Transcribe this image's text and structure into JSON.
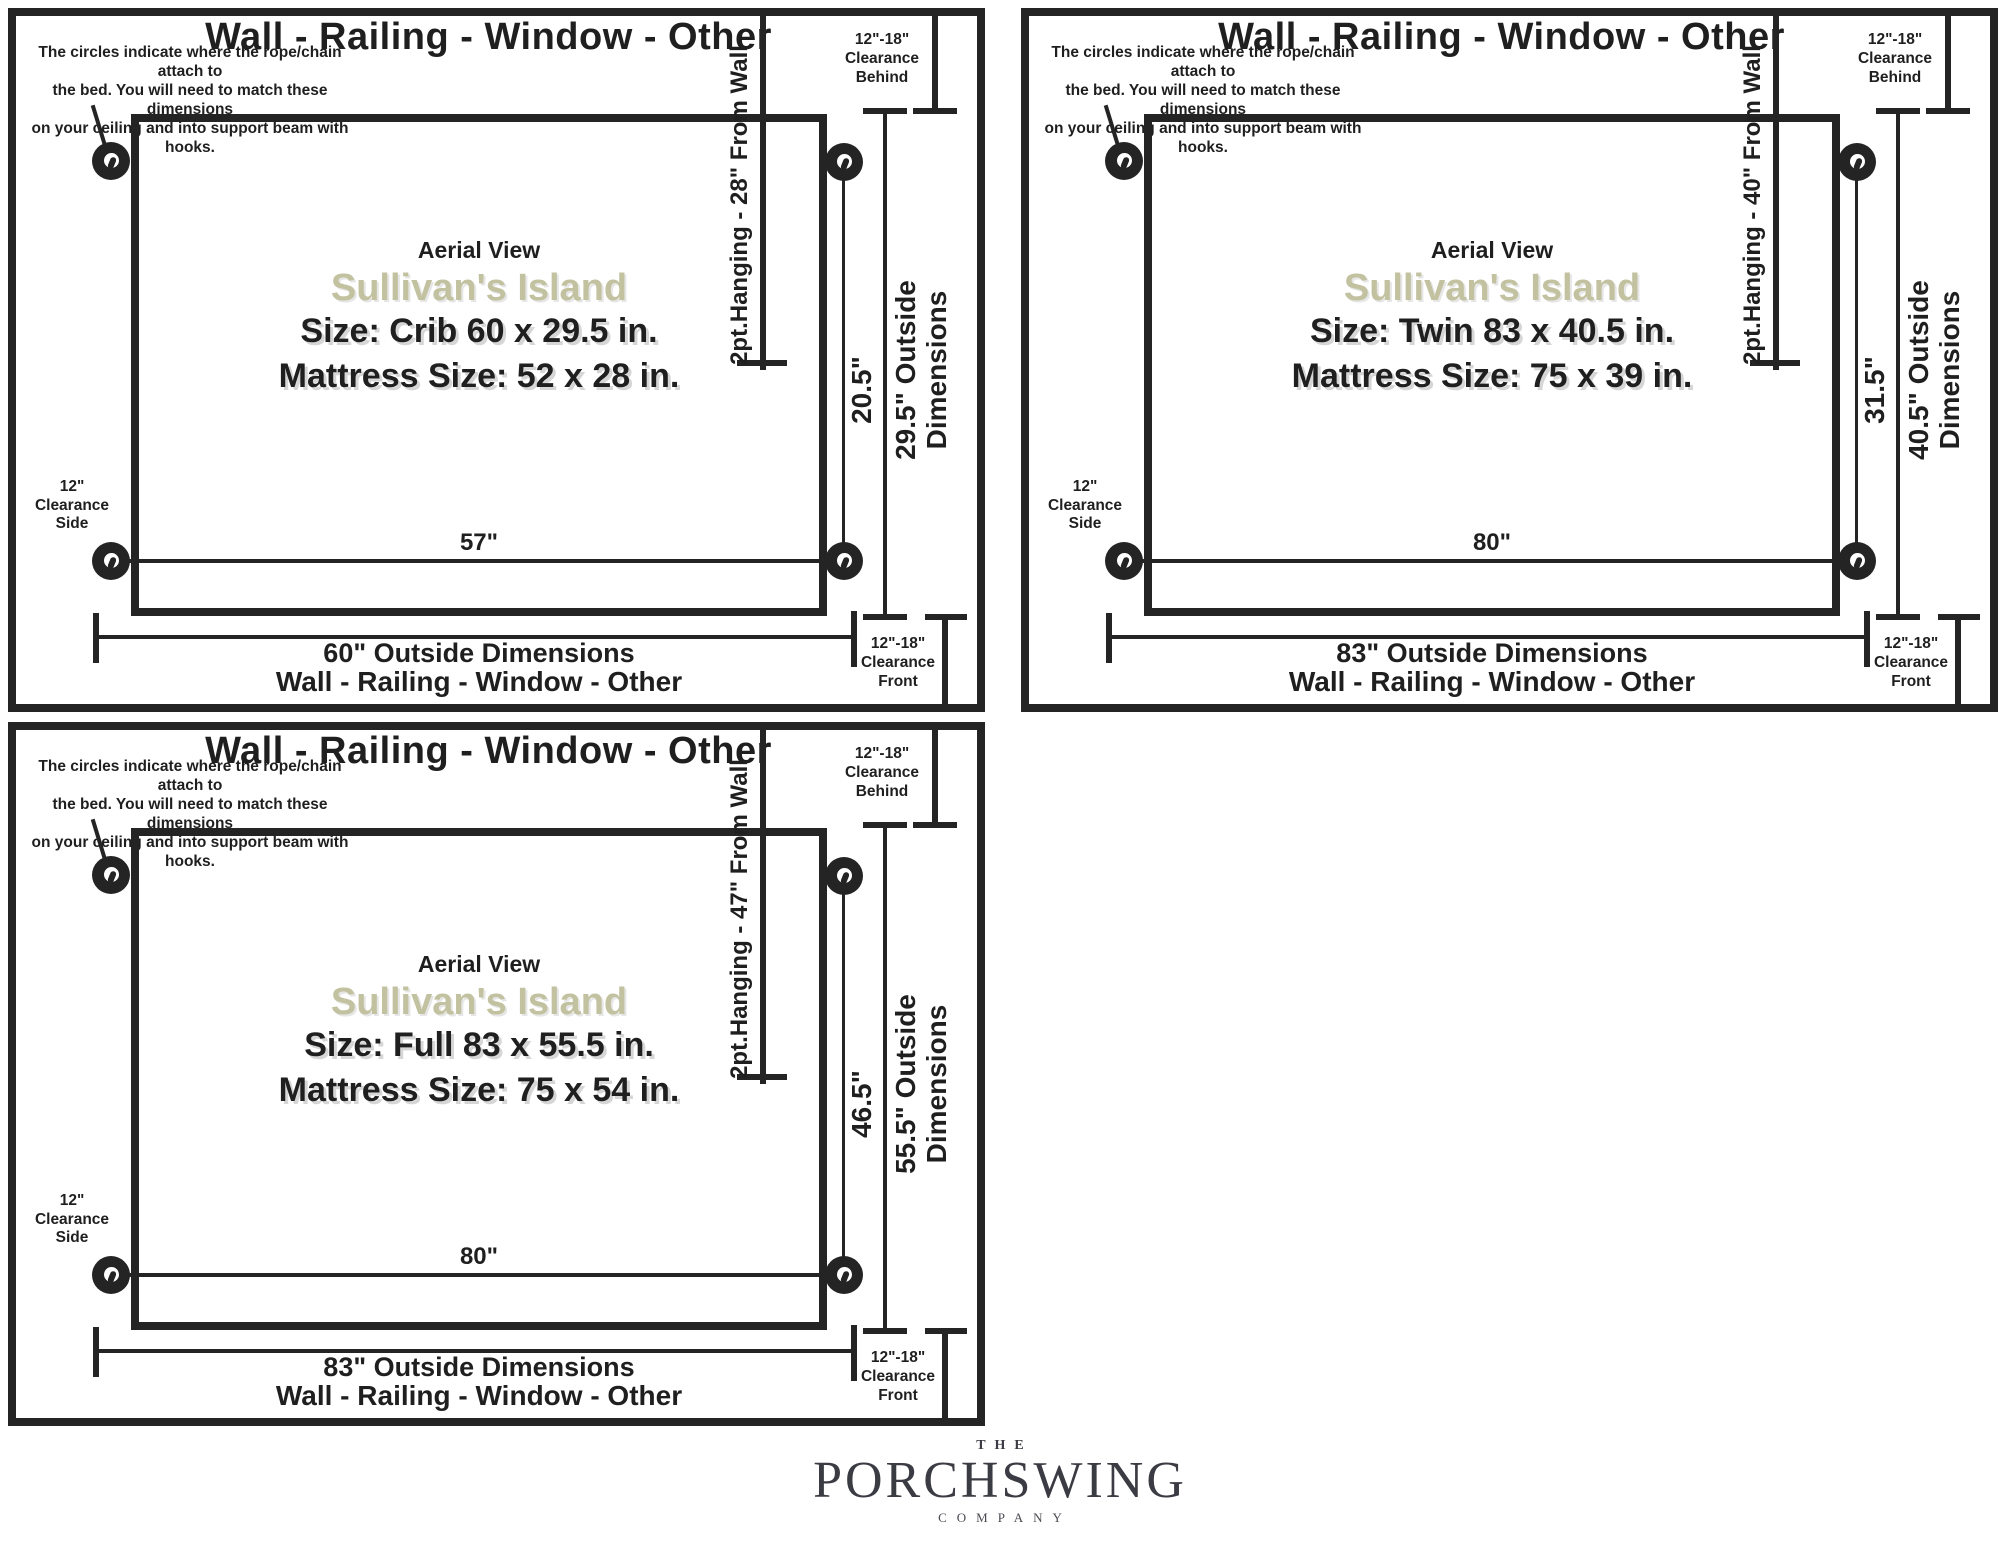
{
  "colors": {
    "line": "#242424",
    "accent_sage": "#c2c2a0",
    "logo_gray": "#3b3b43"
  },
  "panels": [
    {
      "id": "crib",
      "wall_label_top": "Wall - Railing - Window - Other",
      "note_lines": {
        "0": "The circles indicate where the rope/chain attach to",
        "1": "the bed. You will need to match these dimensions",
        "2": "on your ceiling and into support beam with hooks."
      },
      "hanging_label": "2pt.Hanging - 28\" From Wall",
      "clearance_behind": {
        "0": "12\"-18\"",
        "1": "Clearance",
        "2": "Behind"
      },
      "clearance_side": {
        "0": "12\"",
        "1": "Clearance",
        "2": "Side"
      },
      "clearance_front": {
        "0": "12\"-18\"",
        "1": "Clearance",
        "2": "Front"
      },
      "aerial": "Aerial View",
      "product": "Sullivan's Island",
      "size_line": "Size: Crib 60 x 29.5 in.",
      "mattress_line": "Mattress Size: 52 x 28 in.",
      "hang_width": "57\"",
      "hang_depth": "20.5\"",
      "outside_depth_line1": "29.5\" Outside",
      "outside_depth_line2": "Dimensions",
      "outside_width": "60\" Outside Dimensions",
      "wall_label_bottom": "Wall - Railing - Window - Other"
    },
    {
      "id": "twin",
      "wall_label_top": "Wall - Railing - Window - Other",
      "note_lines": {
        "0": "The circles indicate where the rope/chain attach to",
        "1": "the bed. You will need to match these dimensions",
        "2": "on your ceiling and into support beam with hooks."
      },
      "hanging_label": "2pt.Hanging - 40\" From Wall",
      "clearance_behind": {
        "0": "12\"-18\"",
        "1": "Clearance",
        "2": "Behind"
      },
      "clearance_side": {
        "0": "12\"",
        "1": "Clearance",
        "2": "Side"
      },
      "clearance_front": {
        "0": "12\"-18\"",
        "1": "Clearance",
        "2": "Front"
      },
      "aerial": "Aerial View",
      "product": "Sullivan's Island",
      "size_line": "Size: Twin 83 x 40.5 in.",
      "mattress_line": "Mattress Size: 75 x 39 in.",
      "hang_width": "80\"",
      "hang_depth": "31.5\"",
      "outside_depth_line1": "40.5\" Outside",
      "outside_depth_line2": "Dimensions",
      "outside_width": "83\" Outside Dimensions",
      "wall_label_bottom": "Wall - Railing - Window - Other"
    },
    {
      "id": "full",
      "wall_label_top": "Wall - Railing - Window - Other",
      "note_lines": {
        "0": "The circles indicate where the rope/chain attach to",
        "1": "the bed. You will need to match these dimensions",
        "2": "on your ceiling and into support beam with hooks."
      },
      "hanging_label": "2pt.Hanging - 47\" From Wall",
      "clearance_behind": {
        "0": "12\"-18\"",
        "1": "Clearance",
        "2": "Behind"
      },
      "clearance_side": {
        "0": "12\"",
        "1": "Clearance",
        "2": "Side"
      },
      "clearance_front": {
        "0": "12\"-18\"",
        "1": "Clearance",
        "2": "Front"
      },
      "aerial": "Aerial View",
      "product": "Sullivan's Island",
      "size_line": "Size: Full 83 x 55.5 in.",
      "mattress_line": "Mattress Size: 75 x 54 in.",
      "hang_width": "80\"",
      "hang_depth": "46.5\"",
      "outside_depth_line1": "55.5\" Outside",
      "outside_depth_line2": "Dimensions",
      "outside_width": "83\" Outside Dimensions",
      "wall_label_bottom": "Wall - Railing - Window - Other"
    }
  ],
  "logo": {
    "the": "THE",
    "name": "PORCHSWING",
    "company": "COMPANY"
  }
}
